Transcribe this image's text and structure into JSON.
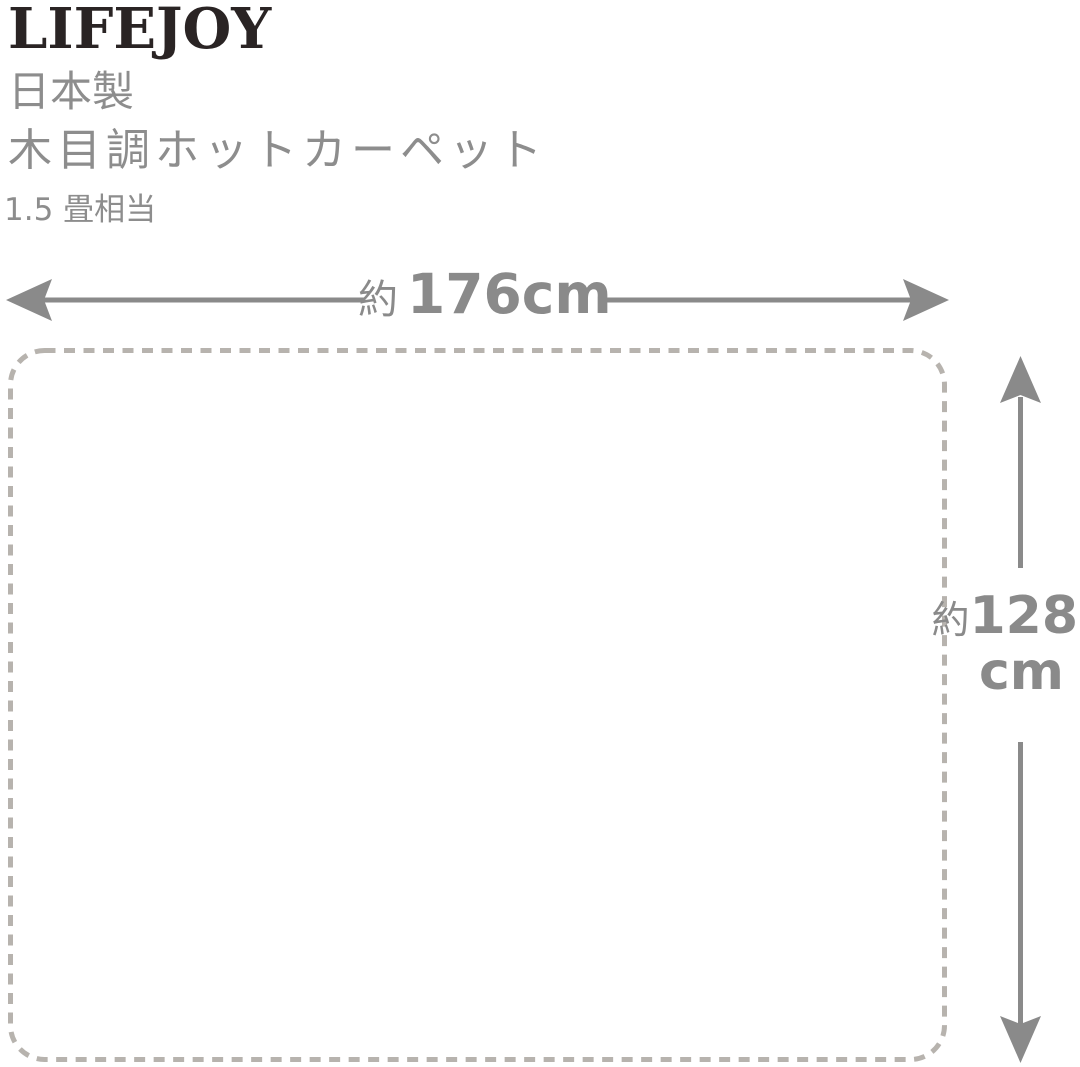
{
  "colors": {
    "ink": "#2a2424",
    "gray-text": "#8d8d8d",
    "arrow": "#8a8a8a",
    "outline": "#b7b3ae",
    "bg": "#ffffff"
  },
  "brand": {
    "logo": "LIFEJOY"
  },
  "product": {
    "origin": "日本製",
    "name": "木目調ホットカーペット",
    "size_class": "1.5 畳相当"
  },
  "diagram": {
    "type": "dimension-diagram",
    "width_label": {
      "approx": "約",
      "value": "176cm"
    },
    "height_label": {
      "approx": "約",
      "value": "128",
      "unit": "cm"
    },
    "carpet": {
      "shape": "dashed-rounded-rectangle",
      "width_cm": 176,
      "height_cm": 128
    }
  }
}
